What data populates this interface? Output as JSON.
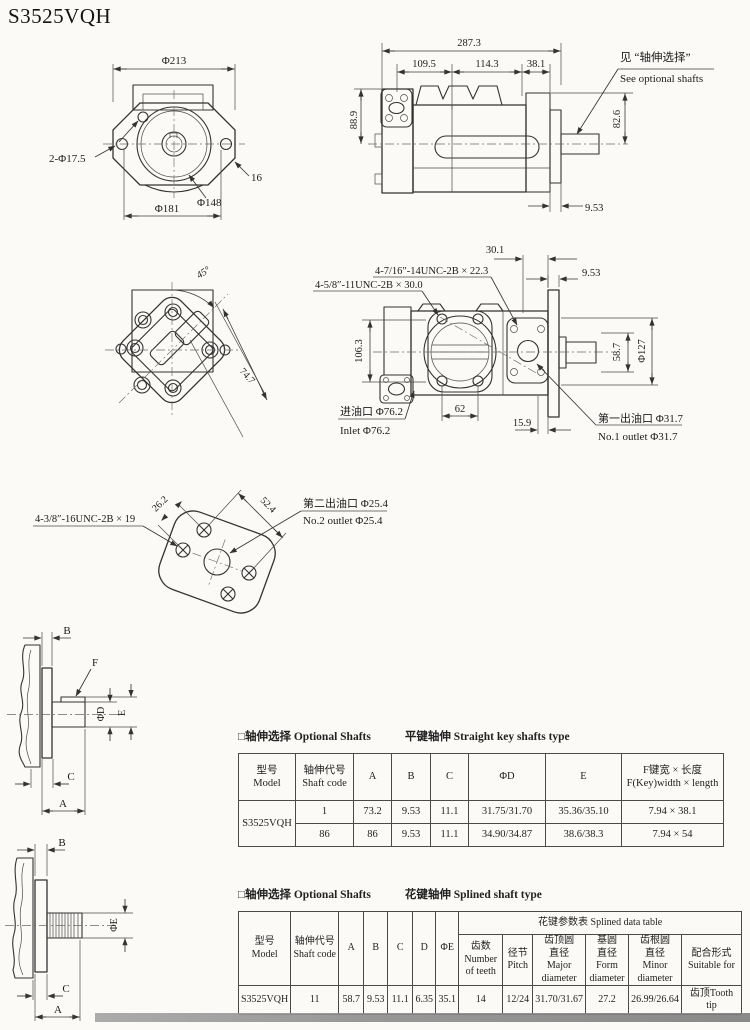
{
  "page": {
    "title": "S3525VQH"
  },
  "colors": {
    "paper": "#fbfaf7",
    "ink": "#1f1f1f",
    "line": "#3b3b3b",
    "artifact_gray": "#8d8d8d"
  },
  "front_view": {
    "dia_213": "Φ213",
    "holes_label": "2-Φ17.5",
    "thickness_16": "16",
    "dia_148": "Φ148",
    "dia_181": "Φ181"
  },
  "side_view": {
    "len_287": "287.3",
    "len_109": "109.5",
    "len_114": "114.3",
    "len_38": "38.1",
    "h_88": "88.9",
    "h_82": "82.6",
    "t_953": "9.53",
    "note_zh": "见 “轴伸选择”",
    "note_en": "See optional shafts"
  },
  "rear_view": {
    "angle_45": "45°",
    "len_74": "74.7"
  },
  "ports_view": {
    "len_301": "30.1",
    "thread_top": "4-7/16″-14UNC-2B × 22.3",
    "thread_left": "4-5/8″-11UNC-2B × 30.0",
    "t_953": "9.53",
    "h_106": "106.3",
    "h_58": "58.7",
    "dia_127": "Φ127",
    "len_62": "62",
    "len_159": "15.9",
    "inlet_zh": "进油口 Φ76.2",
    "inlet_en": "Inlet Φ76.2",
    "outlet1_zh": "第一出油口 Φ31.7",
    "outlet1_en": "No.1 outlet Φ31.7"
  },
  "outlet_flange_view": {
    "thread": "4-3/8″-16UNC-2B × 19",
    "len_262": "26.2",
    "len_524": "52.4",
    "outlet2_zh": "第二出油口 Φ25.4",
    "outlet2_en": "No.2 outlet Φ25.4"
  },
  "key_shaft_view": {
    "a": "A",
    "b": "B",
    "c": "C",
    "f": "F",
    "dia_d": "ΦD",
    "e": "E"
  },
  "spline_shaft_view": {
    "a": "A",
    "b": "B",
    "c": "C",
    "dia_e": "ΦE"
  },
  "straight_table": {
    "title_zh_en": "□轴伸选择 Optional Shafts",
    "title_type": "平键轴伸 Straight  key shafts type",
    "headers": [
      "型号\nModel",
      "轴伸代号\nShaft code",
      "A",
      "B",
      "C",
      "ΦD",
      "E",
      "F键宽 × 长度\nF(Key)width × length"
    ],
    "model": "S3525VQH",
    "rows": [
      [
        "1",
        "73.2",
        "9.53",
        "11.1",
        "31.75/31.70",
        "35.36/35.10",
        "7.94 × 38.1"
      ],
      [
        "86",
        "86",
        "9.53",
        "11.1",
        "34.90/34.87",
        "38.6/38.3",
        "7.94 × 54"
      ]
    ]
  },
  "splined_table": {
    "title_zh_en": "□轴伸选择 Optional Shafts",
    "title_type": "花键轴伸 Splined shaft type",
    "group_header": "花键参数表  Splined data table",
    "headers_left": [
      "型号\nModel",
      "轴伸代号\nShaft code",
      "A",
      "B",
      "C",
      "D",
      "ΦE"
    ],
    "headers_spline": [
      "齿数\nNumber\nof teeth",
      "径节\nPitch",
      "齿顶圆\n直径\nMajor\ndiameter",
      "基圆\n直径\nForm\ndiameter",
      "齿根圆\n直径\nMinor\ndiameter",
      "配合形式\nSuitable for"
    ],
    "row": [
      "S3525VQH",
      "11",
      "58.7",
      "9.53",
      "11.1",
      "6.35",
      "35.1",
      "14",
      "12/24",
      "31.70/31.67",
      "27.2",
      "26.99/26.64",
      "齿顶Tooth tip"
    ]
  }
}
